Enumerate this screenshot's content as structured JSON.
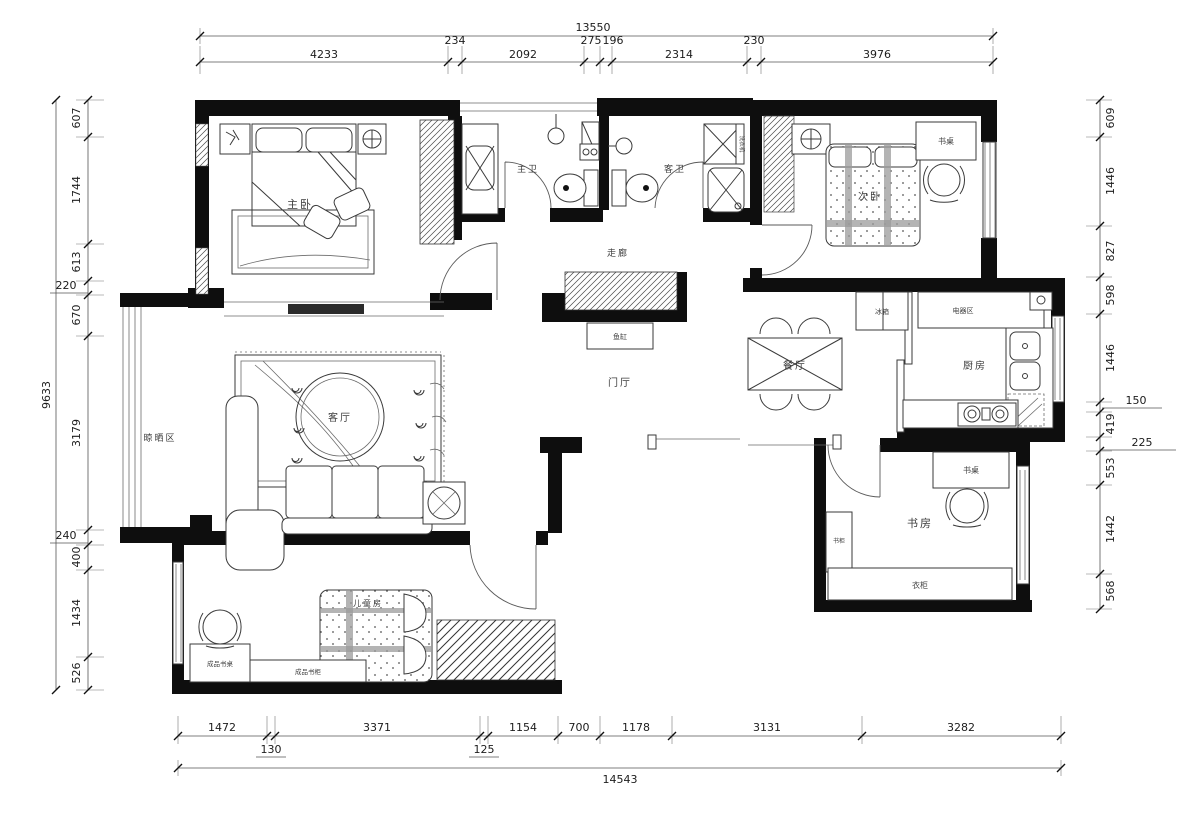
{
  "drawing": {
    "rooms": {
      "master_bedroom": "主卧",
      "master_bath": "主卫",
      "guest_bath": "客卫",
      "second_bedroom": "次卧",
      "corridor": "走廊",
      "entry_hall": "门厅",
      "dining_room": "餐厅",
      "kitchen": "厨房",
      "living_room": "客厅",
      "drying_area": "晾晒区",
      "study": "书房",
      "kids_room": "儿童房"
    },
    "furniture": {
      "desk_bedroom2": "书桌",
      "fridge": "冰箱",
      "appliance_zone": "电器区",
      "fish_tank": "鱼缸",
      "desk_study": "书桌",
      "bookcase_study": "书柜",
      "wardrobe_study": "衣柜",
      "kids_desk": "成品书桌",
      "kids_bookcase": "成品书柜",
      "washer": "洗衣机"
    },
    "dims": {
      "top": {
        "total": "13550",
        "segments": [
          "4233",
          "234",
          "2092",
          "275",
          "196",
          "2314",
          "230",
          "3976"
        ]
      },
      "bottom": {
        "total": "14543",
        "segments": [
          "1472",
          "130",
          "3371",
          "125",
          "1154",
          "700",
          "1178",
          "3131",
          "3282"
        ]
      },
      "left": {
        "total": "9633",
        "segments": [
          "607",
          "1744",
          "613",
          "220",
          "670",
          "3179",
          "240",
          "400",
          "1434",
          "526"
        ]
      },
      "right": {
        "segments": [
          "609",
          "1446",
          "827",
          "598",
          "1446",
          "150",
          "419",
          "225",
          "553",
          "1442",
          "568"
        ]
      }
    },
    "colors": {
      "wall": "#0e0e0e",
      "line": "#3a3a3a",
      "dim": "#555555",
      "bg": "#ffffff"
    }
  }
}
